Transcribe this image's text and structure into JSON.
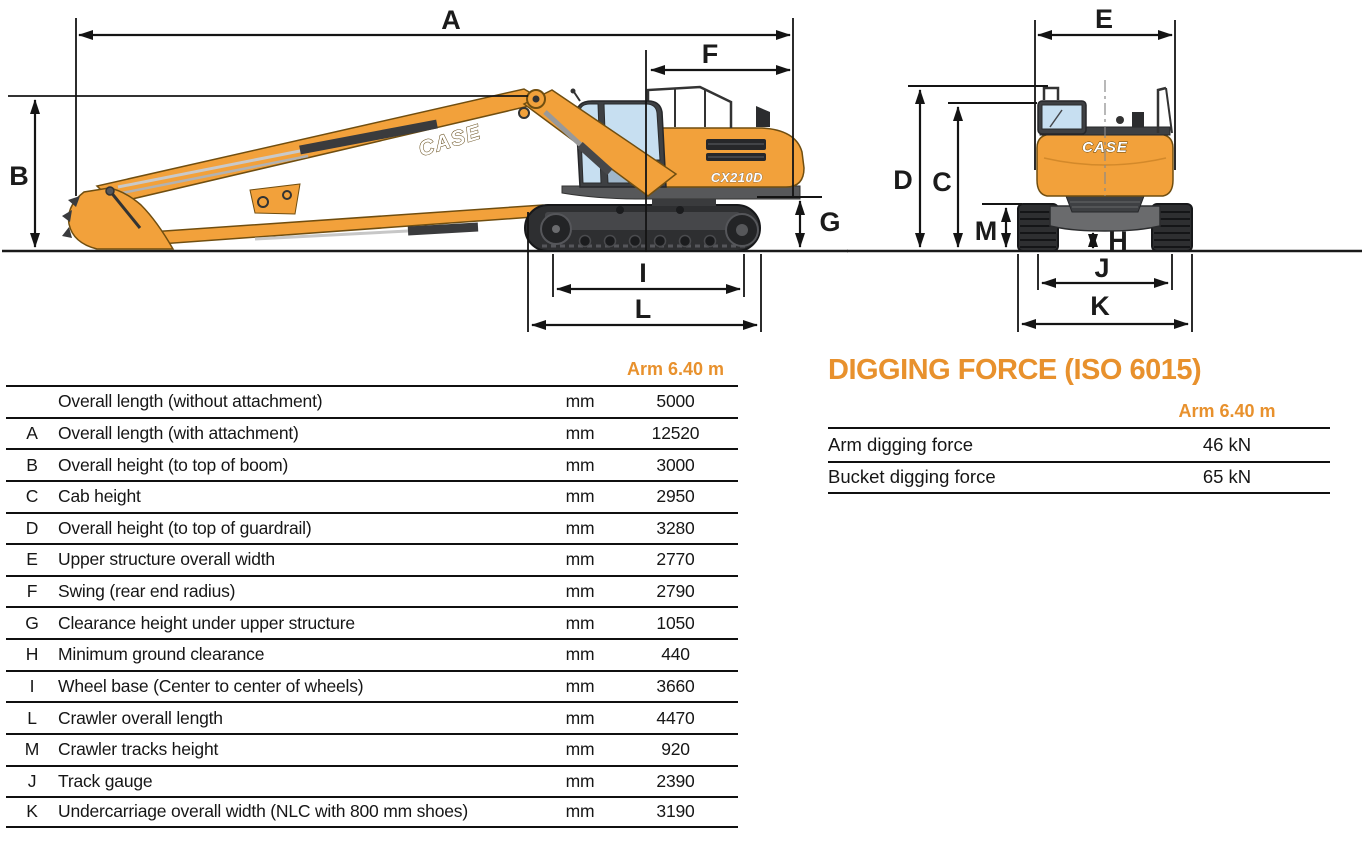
{
  "side_view": {
    "brand_boom": "CASE",
    "model": "CX210D",
    "dim_labels": {
      "A": "A",
      "B": "B",
      "F": "F",
      "G": "G",
      "I": "I",
      "L": "L"
    }
  },
  "rear_view": {
    "brand_rear": "CASE",
    "dim_labels": {
      "E": "E",
      "D": "D",
      "C": "C",
      "M": "M",
      "H": "H",
      "J": "J",
      "K": "K"
    }
  },
  "dim_table": {
    "column_header": "Arm 6.40 m",
    "rows": [
      {
        "letter": "",
        "label": "Overall length (without attachment)",
        "unit": "mm",
        "value": "5000"
      },
      {
        "letter": "A",
        "label": "Overall length (with attachment)",
        "unit": "mm",
        "value": "12520"
      },
      {
        "letter": "B",
        "label": "Overall height (to top of boom)",
        "unit": "mm",
        "value": "3000"
      },
      {
        "letter": "C",
        "label": "Cab height",
        "unit": "mm",
        "value": "2950"
      },
      {
        "letter": "D",
        "label": "Overall height (to top of guardrail)",
        "unit": "mm",
        "value": "3280"
      },
      {
        "letter": "E",
        "label": "Upper structure overall width",
        "unit": "mm",
        "value": "2770"
      },
      {
        "letter": "F",
        "label": "Swing (rear end radius)",
        "unit": "mm",
        "value": "2790"
      },
      {
        "letter": "G",
        "label": "Clearance height under upper structure",
        "unit": "mm",
        "value": "1050"
      },
      {
        "letter": "H",
        "label": "Minimum ground clearance",
        "unit": "mm",
        "value": "440"
      },
      {
        "letter": "I",
        "label": "Wheel base (Center to center of wheels)",
        "unit": "mm",
        "value": "3660"
      },
      {
        "letter": "L",
        "label": "Crawler overall length",
        "unit": "mm",
        "value": "4470"
      },
      {
        "letter": "M",
        "label": "Crawler tracks height",
        "unit": "mm",
        "value": "920"
      },
      {
        "letter": "J",
        "label": "Track gauge",
        "unit": "mm",
        "value": "2390"
      },
      {
        "letter": "K",
        "label": "Undercarriage overall width (NLC with 800 mm shoes)",
        "unit": "mm",
        "value": "3190"
      }
    ]
  },
  "digging_force": {
    "title": "DIGGING FORCE (ISO 6015)",
    "column_header": "Arm 6.40 m",
    "rows": [
      {
        "label": "Arm digging force",
        "value": "46 kN"
      },
      {
        "label": "Bucket digging force",
        "value": "65 kN"
      }
    ]
  },
  "colors": {
    "accent_orange": "#E8912D",
    "machine_orange": "#F2A13B",
    "track_dark": "#2E2F31",
    "rule_black": "#101010"
  }
}
